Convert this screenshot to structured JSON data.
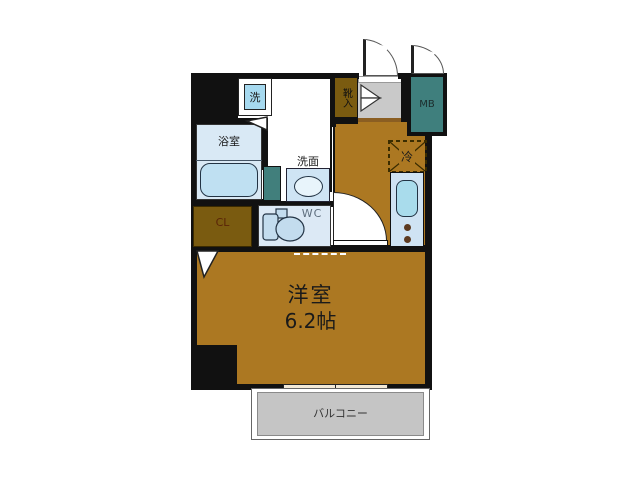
{
  "plan": {
    "type": "apartment-floor-plan",
    "labels": {
      "washer": "洗",
      "bathroom": "浴室",
      "washbasin": "洗面",
      "wc": "WC",
      "closet": "CL",
      "shoe_cabinet": "靴入",
      "meter_box": "MB",
      "refrigerator": "冷",
      "main_room_name": "洋室",
      "main_room_size": "6.2帖",
      "balcony": "バルコニー"
    },
    "colors": {
      "wall": "#111111",
      "floor_wood": "#AC7822",
      "closet_wood": "#7A5B10",
      "meter_box_teal": "#3F7F7D",
      "bath_blue": "#D9E9F5",
      "tub_blue": "#BFE0F2",
      "fixture_blue": "#CFE3F3",
      "entrance_gray": "#C9C9C9",
      "balcony_gray": "#C5C5C5",
      "window_cream": "#F2E9D7"
    }
  }
}
